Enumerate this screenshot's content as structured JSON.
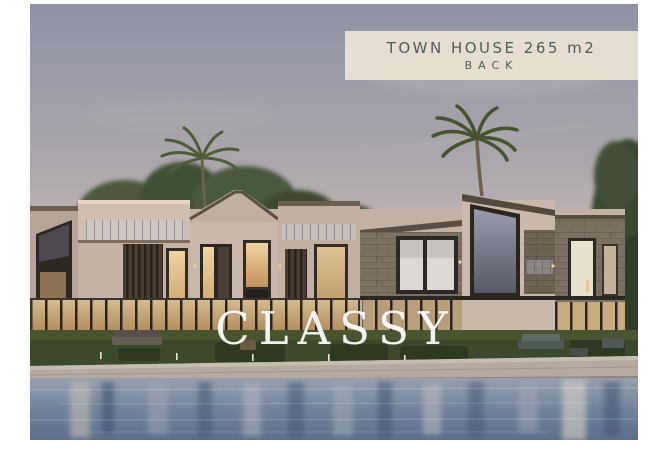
{
  "photo": {
    "label_box": {
      "line1": "TOWN HOUSE 265 m2",
      "line2": "BACK",
      "bg_color": "#e9e1d3",
      "text_color": "#4f5e55"
    },
    "watermark": {
      "text": "CLASSY",
      "color": "#ffffff"
    },
    "palette": {
      "sky_top": "#8e92a4",
      "sky_horizon": "#d8c6bb",
      "wall_beige": "#c4b3a8",
      "stone_cladding": "#7c6f63",
      "window_frame_dark": "#332c25",
      "window_glow": "#e3b77f",
      "tree_green": "#46553a",
      "lawn_green": "#3c4a2c",
      "stone_ledge": "#b5aaa0",
      "water_light": "#97a0af",
      "water_dark": "#5d6e8b"
    }
  }
}
